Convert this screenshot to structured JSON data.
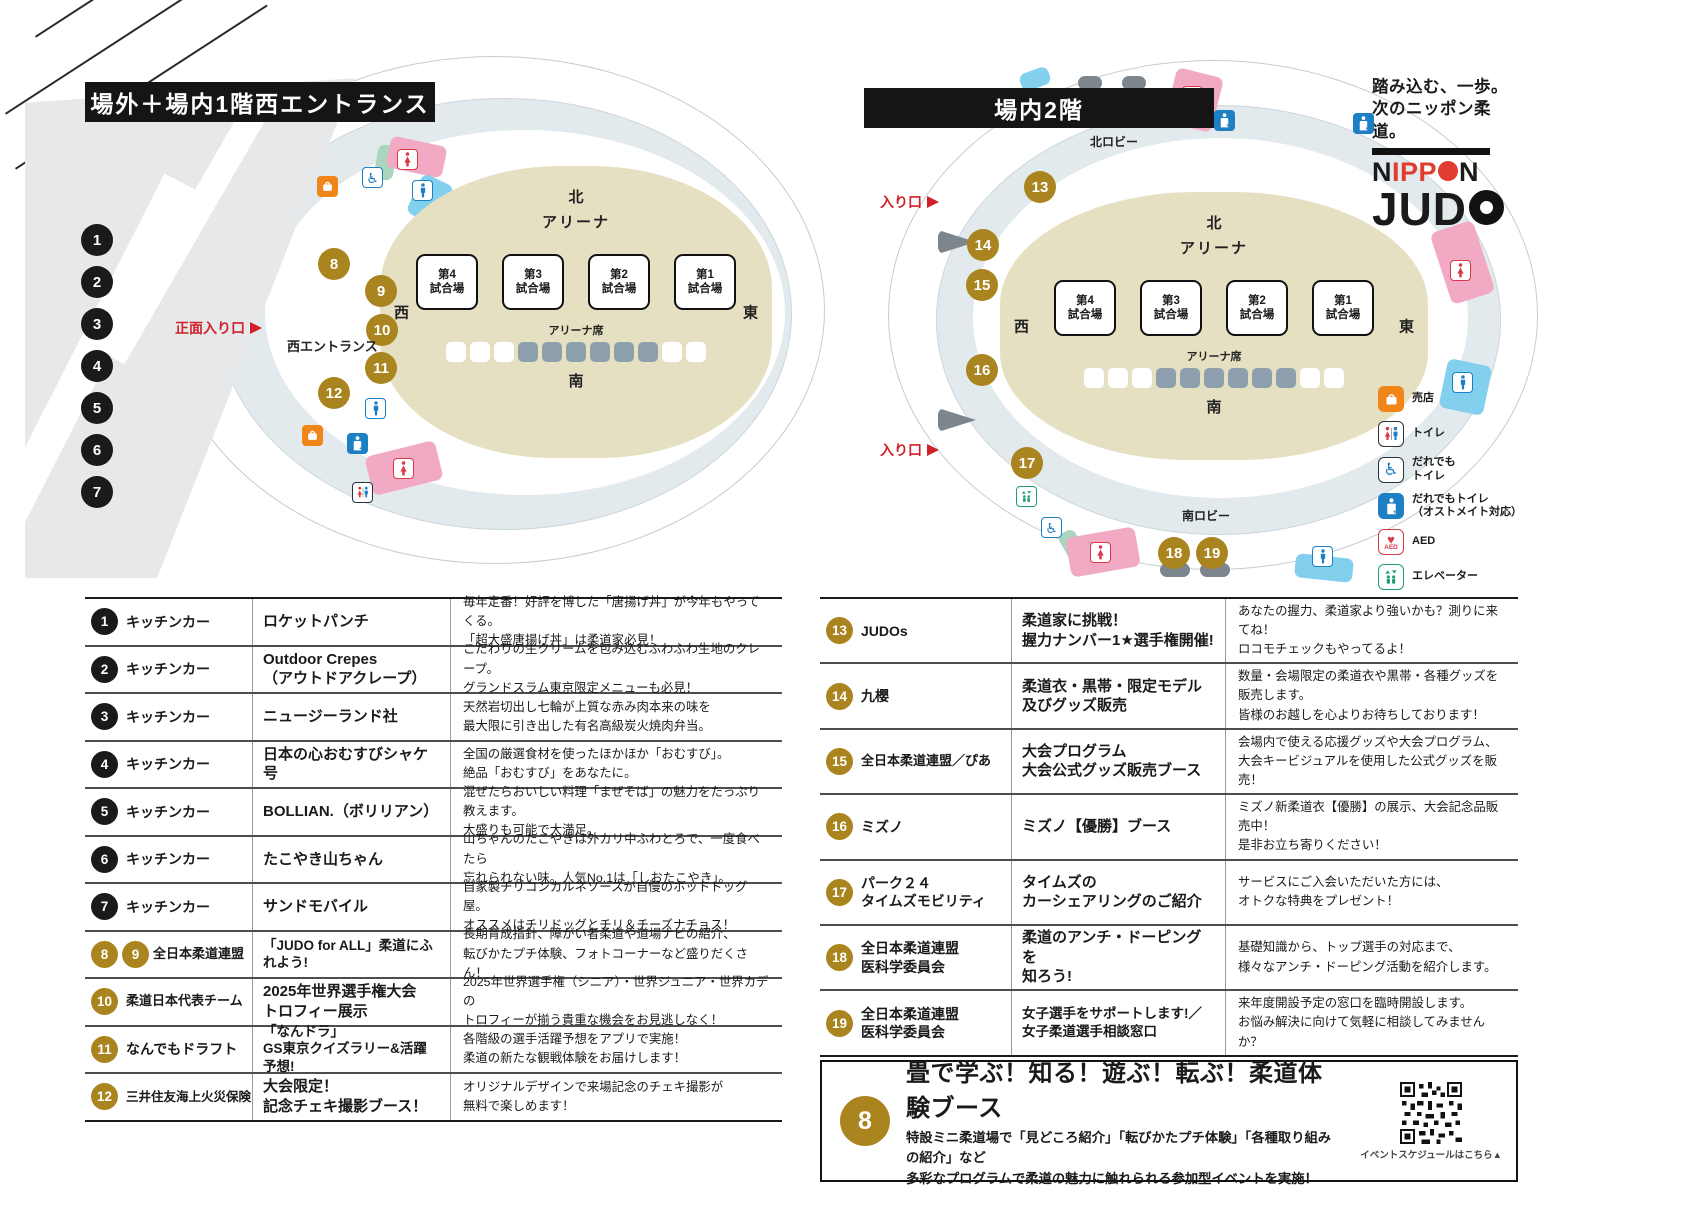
{
  "arena": {
    "north": "北",
    "label": "アリーナ",
    "seats_label": "アリーナ席",
    "south": "南",
    "west": "西",
    "east": "東",
    "courts": [
      "第4\n試合場",
      "第3\n試合場",
      "第2\n試合場",
      "第1\n試合場"
    ]
  },
  "left_map": {
    "title": "場外＋場内1階西エントランス",
    "front_entrance": "正面入り口",
    "west_entrance": "西エントランス",
    "markers_black": [
      "1",
      "2",
      "3",
      "4",
      "5",
      "6",
      "7"
    ],
    "markers_gold": [
      "8",
      "9",
      "10",
      "11",
      "12"
    ]
  },
  "right_map": {
    "title": "場内2階",
    "north_lobby": "北ロビー",
    "south_lobby": "南ロビー",
    "entrance_top": "入り口",
    "entrance_bottom": "入り口",
    "markers_gold": [
      "13",
      "14",
      "15",
      "16",
      "17",
      "18",
      "19"
    ]
  },
  "logo": {
    "tagline1": "踏み込む、一歩。",
    "tagline2": "次のニッポン柔道。",
    "brand_n1": "N",
    "brand_ipp": "IPP",
    "brand_n2": "N",
    "brand_jud": "JUD"
  },
  "legend": {
    "items": [
      {
        "icon": "shop-icon",
        "label": "売店"
      },
      {
        "icon": "toilet-icon",
        "label": "トイレ"
      },
      {
        "icon": "accessible-toilet-icon",
        "label": "だれでも\nトイレ"
      },
      {
        "icon": "ostomate-toilet-icon",
        "label": "だれでもトイレ\n（オストメイト対応）"
      },
      {
        "icon": "aed-icon",
        "label": "AED"
      },
      {
        "icon": "elevator-icon",
        "label": "エレベーター"
      }
    ]
  },
  "left_table": {
    "rows": [
      {
        "num": "1",
        "category": "キッチンカー",
        "name": "ロケットパンチ",
        "desc": "毎年定番！好評を博した「唐揚げ丼」が今年もやってくる。\n「超大盛唐揚げ丼」は柔道家必見！"
      },
      {
        "num": "2",
        "category": "キッチンカー",
        "name": "Outdoor Crepes\n（アウトドアクレープ）",
        "desc": "こだわりの生クリームを包み込むふわふわ生地のクレープ。\nグランドスラム東京限定メニューも必見！"
      },
      {
        "num": "3",
        "category": "キッチンカー",
        "name": "ニュージーランド社",
        "desc": "天然岩切出し七輪が上質な赤み肉本来の味を\n最大限に引き出した有名高級炭火焼肉弁当。"
      },
      {
        "num": "4",
        "category": "キッチンカー",
        "name": "日本の心おむすびシャケ号",
        "desc": "全国の厳選食材を使ったほかほか「おむすび」。\n絶品「おむすび」をあなたに。"
      },
      {
        "num": "5",
        "category": "キッチンカー",
        "name": "BOLLIAN.（ボリリアン）",
        "desc": "混ぜたらおいしい料理「まぜそば」の魅力をたっぷり教えます。\n大盛りも可能で大満足。"
      },
      {
        "num": "6",
        "category": "キッチンカー",
        "name": "たこやき山ちゃん",
        "desc": "山ちゃんのたこやきは外カリ中ふわとろで、一度食べたら\n忘れられない味。人気No.1は「しおたこやき」。"
      },
      {
        "num": "7",
        "category": "キッチンカー",
        "name": "サンドモバイル",
        "desc": "自家製チリコンカルネソースが自慢のホットドッグ屋。\nオススメはチリドッグとチリ＆チーズナチョス！"
      },
      {
        "num": "8",
        "num2": "9",
        "category": "全日本柔道連盟",
        "name": "「JUDO for ALL」柔道にふれよう!",
        "desc": "長期育成指針、障がい者柔道や道場ナビの紹介、\n転びかたプチ体験、フォトコーナーなど盛りだくさん！"
      },
      {
        "num": "10",
        "category": "柔道日本代表チーム",
        "name": "2025年世界選手権大会\nトロフィー展示",
        "desc": "2025年世界選手権（シニア）・世界ジュニア・世界カデの\nトロフィーが揃う貴重な機会をお見逃しなく！"
      },
      {
        "num": "11",
        "category": "なんでもドラフト",
        "name": "「なんドラ」\nGS東京クイズラリー&活躍予想!",
        "desc": "各階級の選手活躍予想をアプリで実施！\n柔道の新たな観戦体験をお届けします！"
      },
      {
        "num": "12",
        "category": "三井住友海上火災保険",
        "name": "大会限定！\n記念チェキ撮影ブース！",
        "desc": "オリジナルデザインで来場記念のチェキ撮影が\n無料で楽しめます！"
      }
    ]
  },
  "right_table": {
    "rows": [
      {
        "num": "13",
        "category": "JUDOs",
        "name": "柔道家に挑戦！\n握力ナンバー1★選手権開催!",
        "desc": "あなたの握力、柔道家より強いかも？測りに来てね！\nロコモチェックもやってるよ！"
      },
      {
        "num": "14",
        "category": "九櫻",
        "name": "柔道衣・黒帯・限定モデル\n及びグッズ販売",
        "desc": "数量・会場限定の柔道衣や黒帯・各種グッズを販売します。\n皆様のお越しを心よりお待ちしております！"
      },
      {
        "num": "15",
        "category": "全日本柔道連盟／ぴあ",
        "name": "大会プログラム\n大会公式グッズ販売ブース",
        "desc": "会場内で使える応援グッズや大会プログラム、\n大会キービジュアルを使用した公式グッズを販売！"
      },
      {
        "num": "16",
        "category": "ミズノ",
        "name": "ミズノ【優勝】ブース",
        "desc": "ミズノ新柔道衣【優勝】の展示、大会記念品販売中！\n是非お立ち寄りください！"
      },
      {
        "num": "17",
        "category": "パーク２４\nタイムズモビリティ",
        "name": "タイムズの\nカーシェアリングのご紹介",
        "desc": "サービスにご入会いただいた方には、\nオトクな特典をプレゼント！"
      },
      {
        "num": "18",
        "category": "全日本柔道連盟\n医科学委員会",
        "name": "柔道のアンチ・ドーピングを\n知ろう!",
        "desc": "基礎知識から、トップ選手の対応まで、\n様々なアンチ・ドーピング活動を紹介します。"
      },
      {
        "num": "19",
        "category": "全日本柔道連盟\n医科学委員会",
        "name": "女子選手をサポートします!／\n女子柔道選手相談窓口",
        "desc": "来年度開設予定の窓口を臨時開設します。\nお悩み解決に向けて気軽に相談してみませんか？"
      }
    ]
  },
  "experience_box": {
    "num": "8",
    "title": "畳で学ぶ！知る！遊ぶ！転ぶ！柔道体験ブース",
    "desc": "特設ミニ柔道場で「見どころ紹介」「転びかたプチ体験」「各種取り組みの紹介」など\n多彩なプログラムで柔道の魅力に触れられる参加型イベントを実施！",
    "qr_caption": "イベントスケジュールはこちら▲"
  },
  "colors": {
    "gold": "#a9841f",
    "black": "#1a1a1a",
    "entrance_red": "#d0202a",
    "arena_tan": "#e6e0c2",
    "corridor": "#e3eaed",
    "seat_slate": "#8d9ead",
    "pink": "#f2a9c4",
    "cyan": "#82cfee",
    "green": "#a9d6bd",
    "shop_orange": "#f08519",
    "toilet_red": "#d93a47",
    "toilet_blue": "#1d7fc4",
    "elevator_green": "#1e9e73",
    "logo_red": "#e23b30"
  }
}
